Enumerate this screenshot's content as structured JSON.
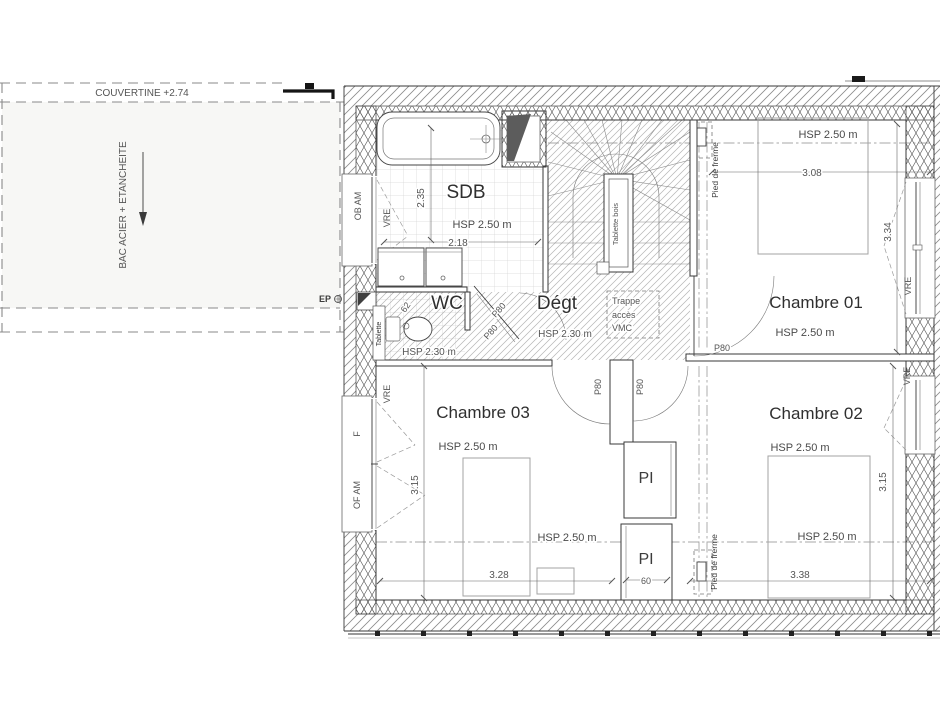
{
  "roof": {
    "couvertine_label": "COUVERTINE +2.74",
    "membrane_label": "BAC ACIER + ETANCHEITE",
    "downspout_label": "EP"
  },
  "rooms": {
    "sdb": {
      "name": "SDB",
      "ceiling": "HSP 2.50 m",
      "width": "2.18",
      "depth": "2.35"
    },
    "wc": {
      "name": "WC",
      "ceiling": "HSP 2.30 m",
      "width": "62",
      "shelf": "Tablette"
    },
    "degagement": {
      "name": "Dégt",
      "ceiling": "HSP 2.30 m"
    },
    "chambre01": {
      "name": "Chambre 01",
      "ceiling": "HSP 2.50 m",
      "ceiling2": "HSP 2.50 m",
      "width": "3.08",
      "depth": "3.34"
    },
    "chambre02": {
      "name": "Chambre 02",
      "ceiling": "HSP 2.50 m",
      "ceiling2": "HSP 2.50 m",
      "width": "3.38",
      "depth": "3.15"
    },
    "chambre03": {
      "name": "Chambre 03",
      "ceiling": "HSP 2.50 m",
      "ceiling2": "HSP 2.50 m",
      "width": "3.28",
      "depth": "3.15"
    },
    "placard_haut": {
      "name": "PI"
    },
    "placard_bas": {
      "name": "PI",
      "width": "60"
    }
  },
  "stairs": {
    "shelf_label": "Tablette bois"
  },
  "attic_hatch": {
    "line1": "Trappe",
    "line2": "accès",
    "line3": "VMC"
  },
  "truss_label": "Pied de frerme",
  "door_label": "P80",
  "window_labels": {
    "vre": "VRE",
    "ob_am": "OB AM",
    "f": "F",
    "of_am": "OF AM"
  },
  "colors": {
    "ink": "#3a3a3a",
    "hatch": "#b0b0b0",
    "insulation": "#5a5a5a",
    "roof_fill": "#f7f7f5"
  }
}
